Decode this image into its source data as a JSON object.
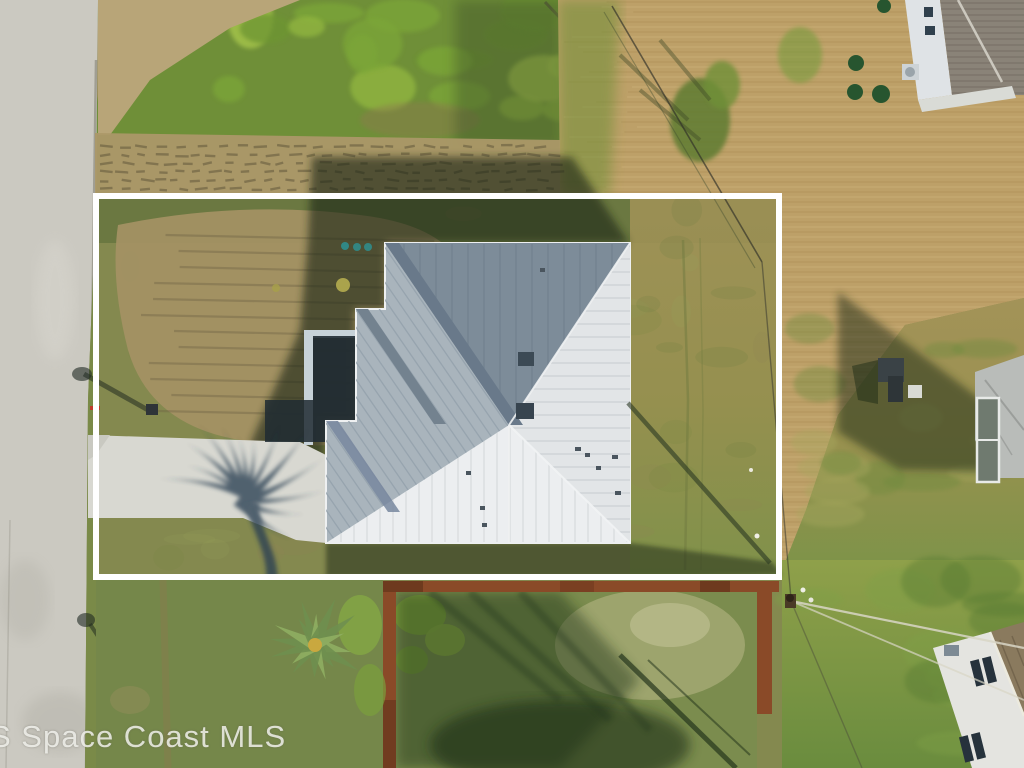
{
  "photo": {
    "description": "Aerial drone photo of a single-family home with a gray metal hip roof on a cleared grass lot, outlined by a white property-boundary rectangle; road on the left, neighboring homes top-right, right and bottom-right, fenced rear yard below",
    "width_px": 1024,
    "height_px": 768
  },
  "watermark": {
    "text": "S Space Coast MLS",
    "color": "#f7f6f2"
  },
  "boundary": {
    "x": 96,
    "y": 196,
    "width": 683,
    "height": 381,
    "stroke_width": 6,
    "color": "#ffffff"
  },
  "palette": {
    "boundary": "#ffffff",
    "road": "#cbc9c1",
    "road_edge": "#8f8d80",
    "driveway": "#d8d8d1",
    "roof_light": "#eceef0",
    "roof_east": "#e2e5e7",
    "roof_mid": "#a9b4bc",
    "roof_dark": "#7d8c99",
    "roof_ridge_dark": "#69798a",
    "grass_base": "#84894f",
    "grass_left": "#7a8a4a",
    "grass_bottom": "#75874a",
    "scrub_green": "#7da338",
    "dirt_tan": "#a39163",
    "track_tan": "#b2a06e",
    "straw": "#bda068",
    "fence_rust": "#8a4a28",
    "shadow_dark": "#1c2817",
    "courtyard_shadow": "#202b33",
    "teal_marker": "#2f8f8f",
    "aloe_green": "#6f8f4f"
  }
}
